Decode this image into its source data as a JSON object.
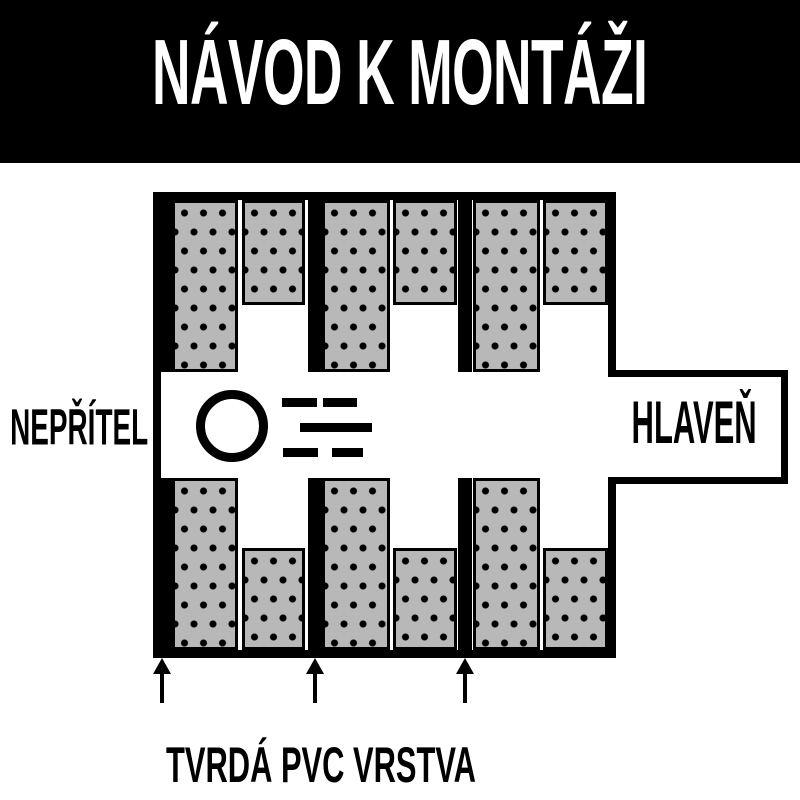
{
  "header": {
    "title": "NÁVOD K MONTÁŽI",
    "bg_color": "#000000",
    "text_color": "#ffffff"
  },
  "diagram": {
    "labels": {
      "left": "NEPŘÍTEL",
      "right": "HLAVEŇ",
      "bottom": "TVRDÁ PVC VRSTVA"
    },
    "colors": {
      "outline_black": "#000000",
      "baffle_gray": "#b8b8b8",
      "background_white": "#ffffff"
    },
    "icons": {
      "bullet": "bullet-circle-icon",
      "motion": "speed-dashes-icon",
      "pointer": "up-arrow-icon"
    },
    "counts": {
      "baffles": 12,
      "pvc_strips": 3,
      "arrows": 3
    }
  }
}
